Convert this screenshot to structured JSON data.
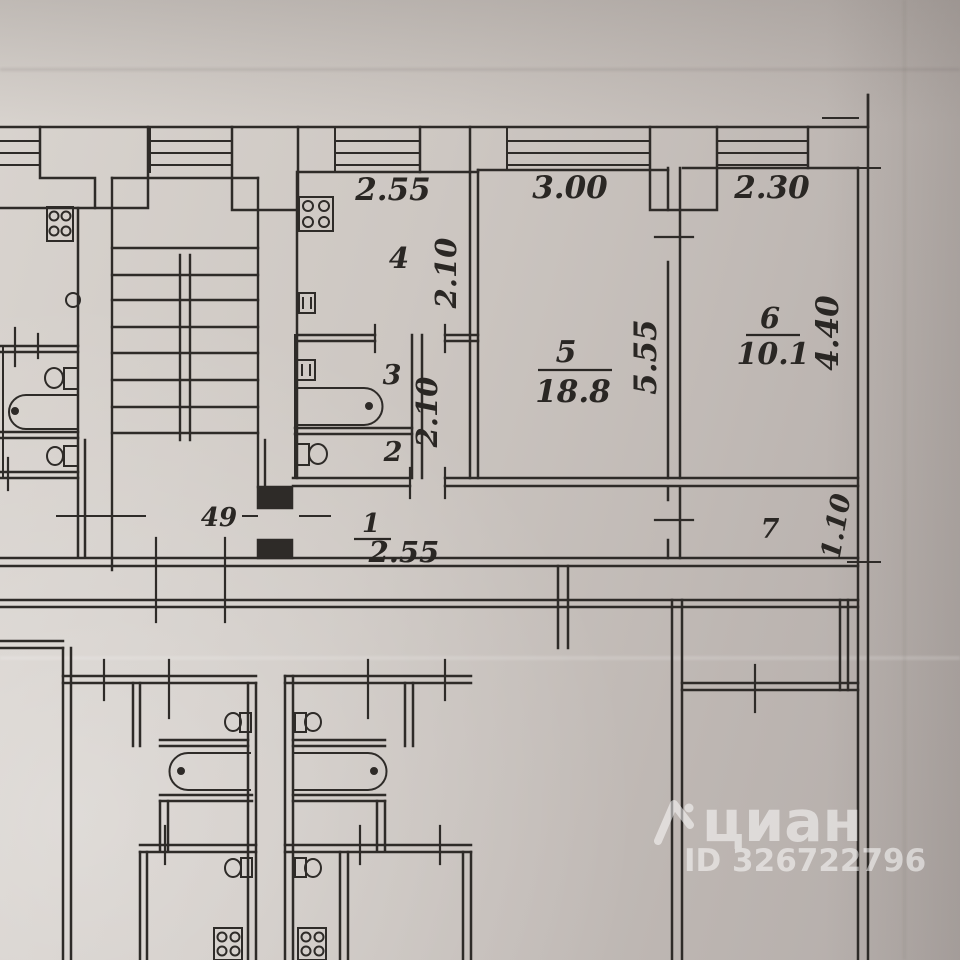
{
  "page": {
    "paper_color": "#c9c2be",
    "ink_color": "#2e2b28",
    "watermark_color": "#ffffff"
  },
  "plan": {
    "apartment_number": "49",
    "top_dimensions": {
      "kitchen_width": "2.55",
      "room5_width": "3.00",
      "room6_width": "2.30"
    },
    "rooms": {
      "room1": {
        "number": "1",
        "width": "2.55"
      },
      "room2": {
        "number": "2"
      },
      "room3": {
        "number": "3"
      },
      "room4": {
        "number": "4",
        "depth": "2.10"
      },
      "room5": {
        "number": "5",
        "area": "18.8",
        "depth": "5.55"
      },
      "room6": {
        "number": "6",
        "area": "10.1",
        "depth": "4.40"
      },
      "room7": {
        "number": "7",
        "depth": "1.10"
      },
      "bath_passage": {
        "width": "2.10"
      }
    },
    "watermark": {
      "brand": "циан",
      "id_line": "ID 326722796"
    }
  }
}
